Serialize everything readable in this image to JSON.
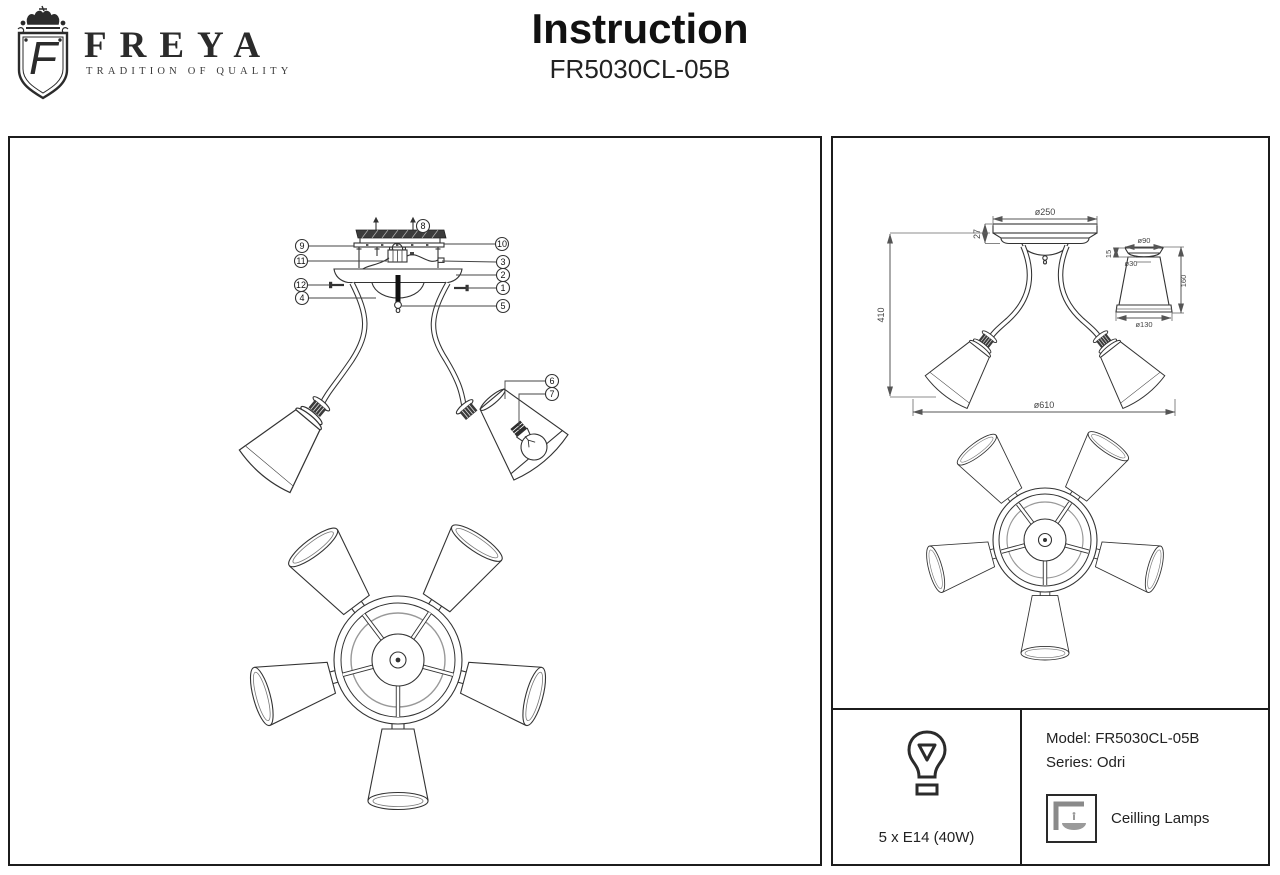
{
  "header": {
    "brand": "FREYA",
    "logo_letter": "F",
    "tagline": "TRADITION OF QUALITY",
    "title": "Instruction",
    "subtitle": "FR5030CL-05B"
  },
  "exploded": {
    "callouts": [
      "1",
      "2",
      "3",
      "4",
      "5",
      "6",
      "7",
      "8",
      "9",
      "10",
      "11",
      "12"
    ]
  },
  "dimensions": {
    "canopy_diameter": "ø250",
    "canopy_height": "27",
    "overall_height": "410",
    "overall_diameter": "ø610",
    "shade_top_diameter": "ø90",
    "socket_hole_diameter": "ø30",
    "shade_cap_height": "15",
    "shade_height": "160",
    "shade_bottom_diameter": "ø130"
  },
  "info": {
    "bulb_spec": "5 x E14 (40W)",
    "model": "Model: FR5030CL-05B",
    "series": "Series: Odri",
    "category": "Ceilling Lamps"
  }
}
